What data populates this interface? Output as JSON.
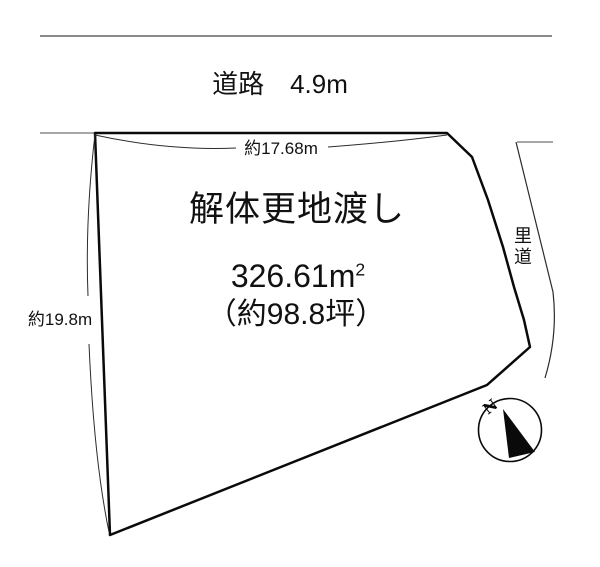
{
  "diagram": {
    "title": "land-plot-sketch",
    "road": {
      "label": "道路　4.9m"
    },
    "plot": {
      "main_label": "解体更地渡し",
      "area_value": "326.61",
      "area_unit": "m",
      "area_unit_sup": "2",
      "tsubo_label": "（約98.8坪）",
      "dim_top_label": "約17.68m",
      "dim_left_label": "約19.8m"
    },
    "side_road": {
      "label": "里道"
    },
    "compass": {
      "north_label": "N"
    },
    "colors": {
      "outline": "#0a0a0a",
      "road_line": "#8a8a8a",
      "thin_line": "#2b2b2b"
    }
  }
}
